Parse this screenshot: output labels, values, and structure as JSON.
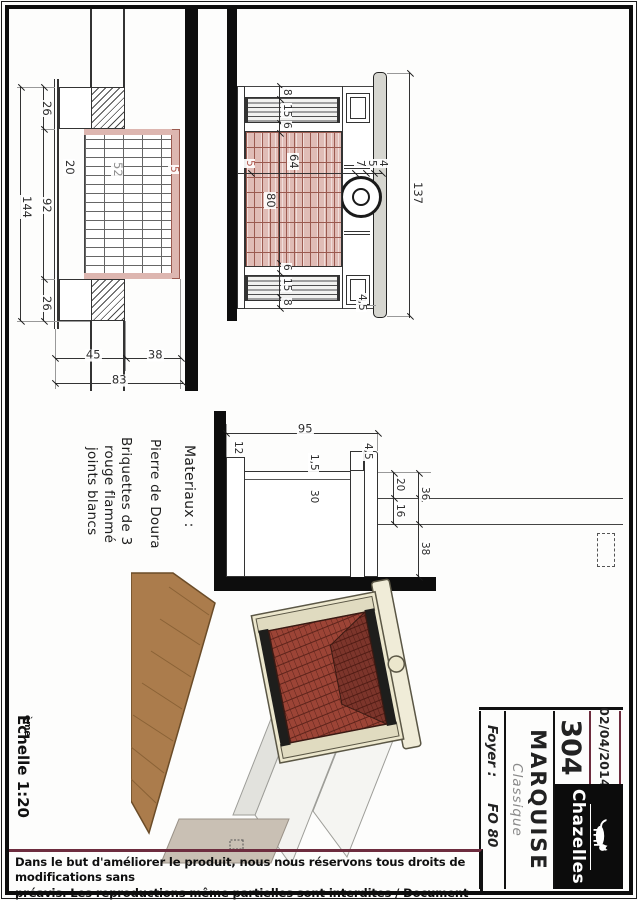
{
  "sheet": {
    "footer_line1": "Dans le but d'améliorer le produit, nous nous réservons tous droits de modifications sans",
    "footer_line2": "préavis. Les reproductions même partielles sont interdites / Document non contractuel.",
    "scale_text": "Echelle 1:20",
    "scale_sup": "ème"
  },
  "title_block": {
    "date": "02/04/2014",
    "drawing_number": "304",
    "brand": "Chazelles",
    "model": "MARQUISE",
    "style": "Classique",
    "foyer_label": "Foyer :",
    "foyer_value": "FO 80"
  },
  "materials": {
    "heading": "Materiaux :",
    "stone": "Pierre de Doura",
    "brick_line1": "Briquettes de 3",
    "brick_line2": "rouge flammé",
    "brick_line3": "joints blancs"
  },
  "front_view": {
    "total_width": "137",
    "width_chain": [
      "8",
      "15",
      "6",
      "80",
      "6",
      "15",
      "8"
    ],
    "height_top": [
      "4",
      "5",
      "7"
    ],
    "opening_height": "64",
    "brick_note": "5",
    "shelf_overhang": "4,5"
  },
  "plan_view": {
    "total_width": "144",
    "width_chain": [
      "26",
      "92",
      "26"
    ],
    "depth_chain": [
      "38",
      "45"
    ],
    "total_depth": "83",
    "wall_thickness": "20",
    "firebox_depth": "52",
    "brick_note": "5"
  },
  "side_view": {
    "total_height": "95",
    "hearth_height": "12",
    "facing_thickness": "1,5",
    "inner_height": "30",
    "step": "4,5",
    "top_total": "36",
    "top_chain": [
      "20",
      "16"
    ],
    "rear_depth": "38"
  }
}
